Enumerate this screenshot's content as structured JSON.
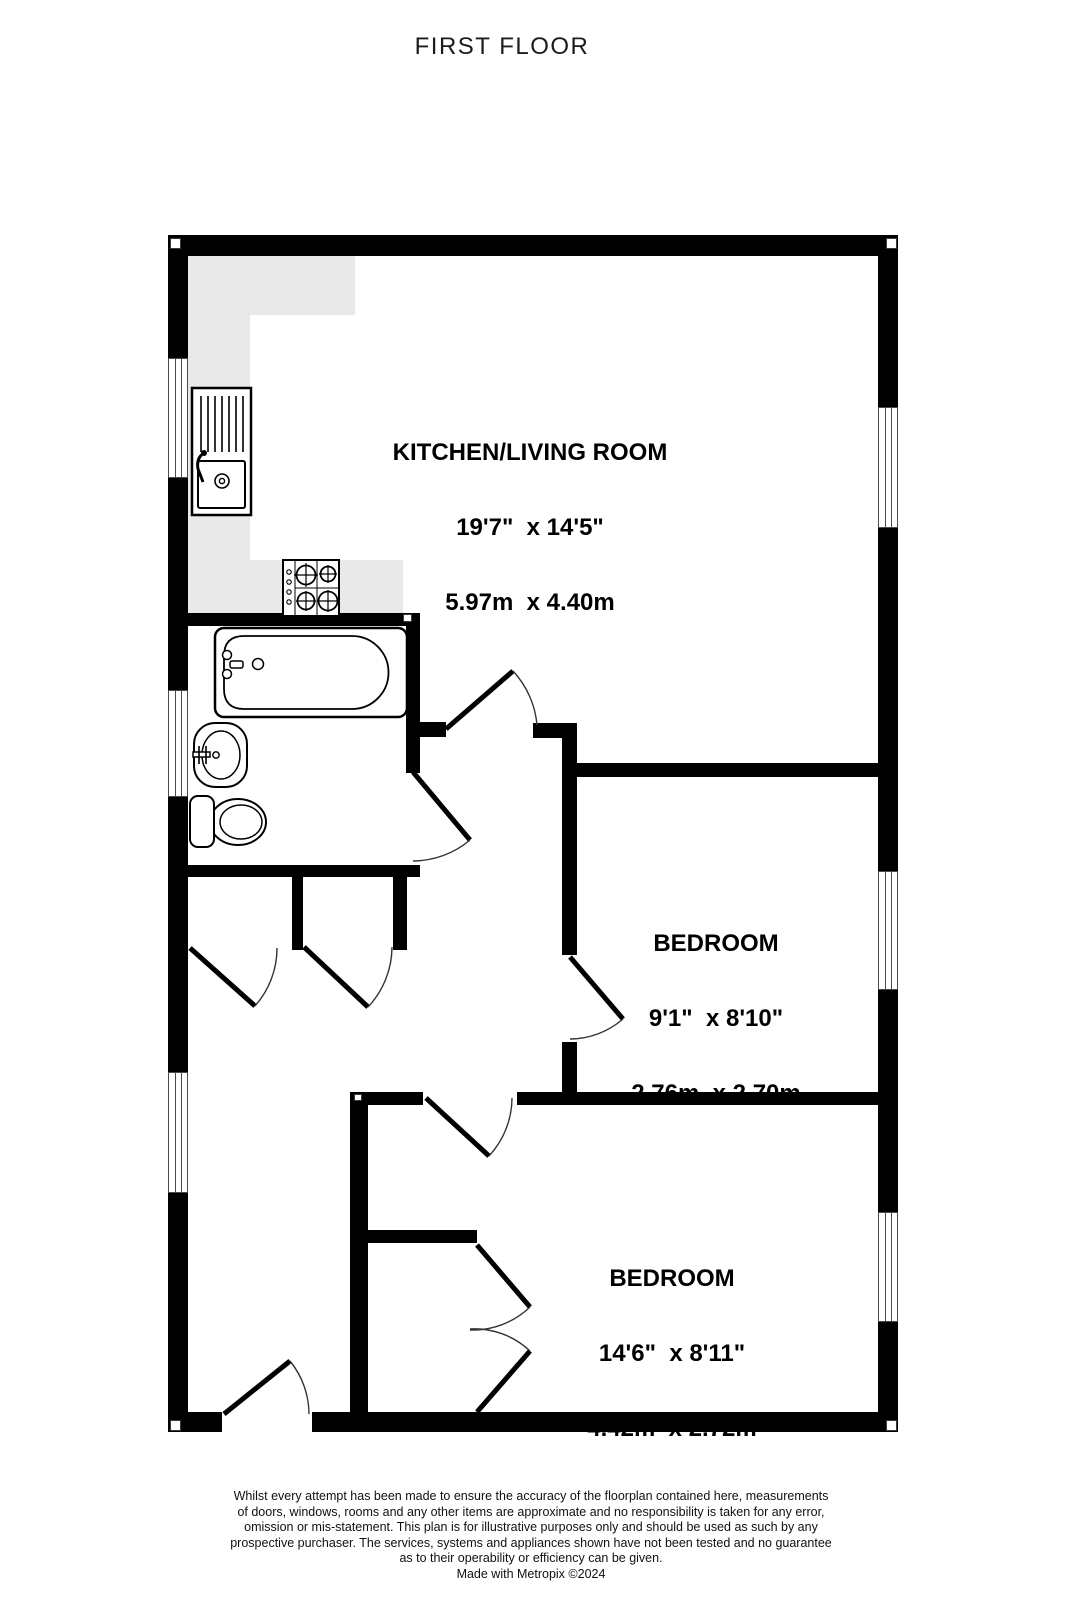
{
  "title": "FIRST FLOOR",
  "rooms": [
    {
      "name": "KITCHEN/LIVING ROOM",
      "imperial": "19'7\"  x 14'5\"",
      "metric": "5.97m  x 4.40m"
    },
    {
      "name": "BEDROOM",
      "imperial": "9'1\"  x 8'10\"",
      "metric": "2.76m  x 2.70m"
    },
    {
      "name": "BEDROOM",
      "imperial": "14'6\"  x 8'11\"",
      "metric": "4.42m  x 2.72m"
    }
  ],
  "fixtures": [
    "kitchen-sink-drainer",
    "hob",
    "bath",
    "wash-basin",
    "toilet"
  ],
  "disclaimer": {
    "lines": [
      "Whilst every attempt has been made to ensure the accuracy of the floorplan contained here, measurements",
      "of doors, windows, rooms and any other items are approximate and no responsibility is taken for any error,",
      "omission or mis-statement. This plan is for illustrative purposes only and should be used as such by any",
      "prospective purchaser. The services, systems and appliances shown have not been tested and no guarantee",
      "as to their operability or efficiency can be given."
    ],
    "credit": "Made with Metropix ©2024"
  },
  "colors": {
    "wall": "#000000",
    "counter": "#e9e9e9",
    "paper": "#ffffff",
    "text": "#000000"
  }
}
